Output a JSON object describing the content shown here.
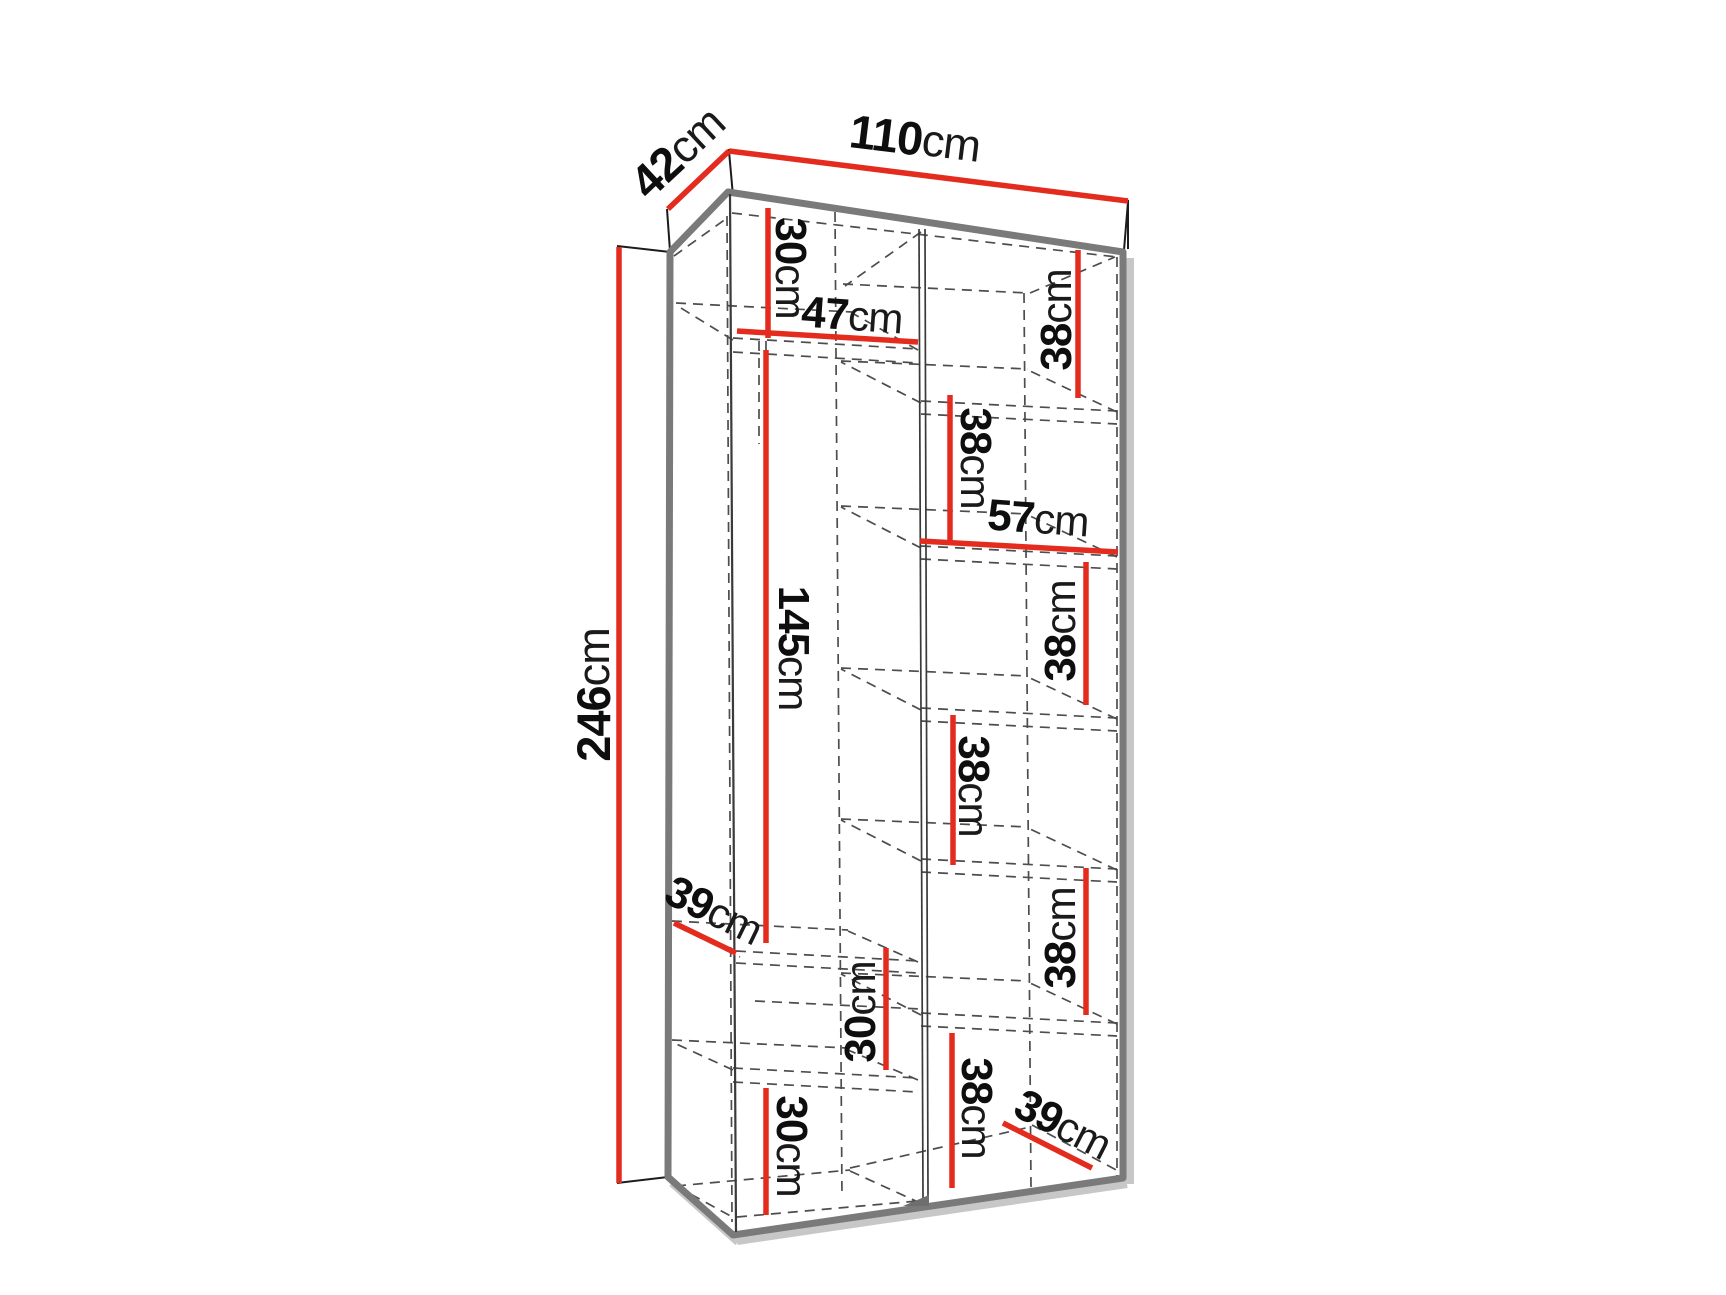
{
  "diagram": {
    "title": "wardrobe-dimension-diagram",
    "unit": "cm",
    "overall": {
      "width_cm": 110,
      "depth_cm": 42,
      "height_cm": 246
    },
    "colors": {
      "dimension_red": "#e32b1e",
      "outline_gray": "#7a7a7a",
      "shadow_gray": "#c7c7c7",
      "dashed_gray": "#4d4d4d",
      "text_black": "#0e0e0e"
    },
    "labels": [
      {
        "id": "dim-42-depth",
        "value": "42",
        "unit": "cm",
        "cx": 677,
        "cy": 152,
        "rot": -43,
        "size": 47,
        "line": {
          "x1": 668,
          "y1": 209,
          "x2": 729,
          "y2": 151
        }
      },
      {
        "id": "dim-110-width",
        "value": "110",
        "unit": "cm",
        "cx": 915,
        "cy": 138,
        "rot": 7,
        "size": 47,
        "line": {
          "x1": 729,
          "y1": 151,
          "x2": 1128,
          "y2": 201
        }
      },
      {
        "id": "dim-246-height",
        "value": "246",
        "unit": "cm",
        "cx": 593,
        "cy": 695,
        "rot": -90,
        "size": 47,
        "line": {
          "x1": 619,
          "y1": 247,
          "x2": 619,
          "y2": 1183
        }
      },
      {
        "id": "dim-30-top-left",
        "value": "30",
        "unit": "cm",
        "cx": 791,
        "cy": 268,
        "rot": 90,
        "size": 44,
        "line": {
          "x1": 768,
          "y1": 208,
          "x2": 768,
          "y2": 338
        }
      },
      {
        "id": "dim-47-shelf",
        "value": "47",
        "unit": "cm",
        "cx": 852,
        "cy": 315,
        "rot": 4,
        "size": 44,
        "line": {
          "x1": 737,
          "y1": 331,
          "x2": 918,
          "y2": 342
        }
      },
      {
        "id": "dim-145-hanging",
        "value": "145",
        "unit": "cm",
        "cx": 794,
        "cy": 648,
        "rot": 90,
        "size": 44,
        "line": {
          "x1": 766,
          "y1": 350,
          "x2": 766,
          "y2": 943
        }
      },
      {
        "id": "dim-39-left-depth",
        "value": "39",
        "unit": "cm",
        "cx": 714,
        "cy": 910,
        "rot": 26,
        "size": 44,
        "line": {
          "x1": 674,
          "y1": 923,
          "x2": 736,
          "y2": 953
        }
      },
      {
        "id": "dim-30-middle",
        "value": "30",
        "unit": "cm",
        "cx": 860,
        "cy": 1012,
        "rot": -90,
        "size": 44,
        "line": {
          "x1": 886,
          "y1": 948,
          "x2": 886,
          "y2": 1070
        }
      },
      {
        "id": "dim-30-bottom-left",
        "value": "30",
        "unit": "cm",
        "cx": 792,
        "cy": 1146,
        "rot": 90,
        "size": 44,
        "line": {
          "x1": 766,
          "y1": 1088,
          "x2": 766,
          "y2": 1215
        }
      },
      {
        "id": "dim-38-right-1",
        "value": "38",
        "unit": "cm",
        "cx": 1056,
        "cy": 320,
        "rot": -90,
        "size": 44,
        "line": {
          "x1": 1078,
          "y1": 250,
          "x2": 1078,
          "y2": 398
        }
      },
      {
        "id": "dim-38-right-2",
        "value": "38",
        "unit": "cm",
        "cx": 976,
        "cy": 458,
        "rot": 90,
        "size": 44,
        "line": {
          "x1": 950,
          "y1": 395,
          "x2": 950,
          "y2": 543
        }
      },
      {
        "id": "dim-57-shelf",
        "value": "57",
        "unit": "cm",
        "cx": 1038,
        "cy": 518,
        "rot": 4,
        "size": 44,
        "line": {
          "x1": 920,
          "y1": 541,
          "x2": 1118,
          "y2": 552
        }
      },
      {
        "id": "dim-38-right-3",
        "value": "38",
        "unit": "cm",
        "cx": 1060,
        "cy": 631,
        "rot": -90,
        "size": 44,
        "line": {
          "x1": 1086,
          "y1": 562,
          "x2": 1086,
          "y2": 705
        }
      },
      {
        "id": "dim-38-right-4",
        "value": "38",
        "unit": "cm",
        "cx": 974,
        "cy": 786,
        "rot": 90,
        "size": 44,
        "line": {
          "x1": 953,
          "y1": 715,
          "x2": 953,
          "y2": 865
        }
      },
      {
        "id": "dim-38-right-5",
        "value": "38",
        "unit": "cm",
        "cx": 1060,
        "cy": 938,
        "rot": -90,
        "size": 44,
        "line": {
          "x1": 1086,
          "y1": 868,
          "x2": 1086,
          "y2": 1015
        }
      },
      {
        "id": "dim-38-right-6",
        "value": "38",
        "unit": "cm",
        "cx": 977,
        "cy": 1108,
        "rot": 90,
        "size": 44,
        "line": {
          "x1": 952,
          "y1": 1033,
          "x2": 952,
          "y2": 1188
        }
      },
      {
        "id": "dim-39-right-depth",
        "value": "39",
        "unit": "cm",
        "cx": 1063,
        "cy": 1124,
        "rot": 27,
        "size": 44,
        "line": {
          "x1": 1003,
          "y1": 1123,
          "x2": 1092,
          "y2": 1168
        }
      }
    ]
  }
}
